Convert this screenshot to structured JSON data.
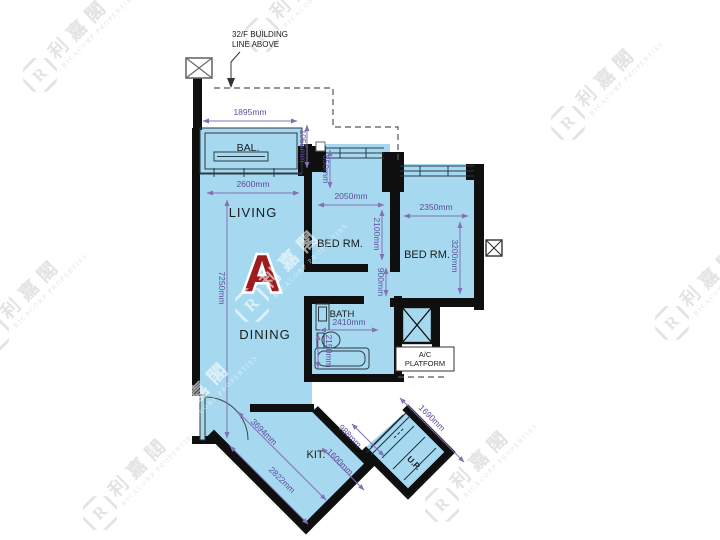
{
  "annotation": {
    "line1": "32/F BUILDING",
    "line2": "LINE ABOVE"
  },
  "unit": {
    "letter": "A"
  },
  "rooms": {
    "balcony": "BAL.",
    "living": "LIVING",
    "dining": "DINING",
    "bedroom1": "BED RM.",
    "bedroom2": "BED RM.",
    "bath": "BATH",
    "kitchen": "KIT.",
    "stairs": "U.P.",
    "ac_platform_line1": "A/C",
    "ac_platform_line2": "PLATFORM"
  },
  "dimensions": {
    "balcony_width": "1895mm",
    "balcony_depth": "1055mm",
    "living_width": "2600mm",
    "living_length": "7250mm",
    "bedroom1_window_bay": "650mm",
    "bedroom1_width": "2050mm",
    "bedroom1_depth": "2100mm",
    "bedroom2_width": "2350mm",
    "bedroom2_depth": "3200mm",
    "corridor": "900mm",
    "bath_width": "2410mm",
    "bath_depth": "2150mm",
    "kitchen_upper_diag": "3694mm",
    "kitchen_lower_diag": "2822mm",
    "kitchen_inner": "1600mm",
    "stair_width": "988mm",
    "stair_length": "1690mm"
  },
  "watermark": {
    "logo_letter": "R",
    "cjk": "利嘉閣",
    "latin": "RICACORP PROPERTIES"
  },
  "colors": {
    "floor": "#a6d9f0",
    "wall": "#0f0f0f",
    "dimension": "#5f4b9e",
    "unit_letter": "#9e1b1f"
  }
}
